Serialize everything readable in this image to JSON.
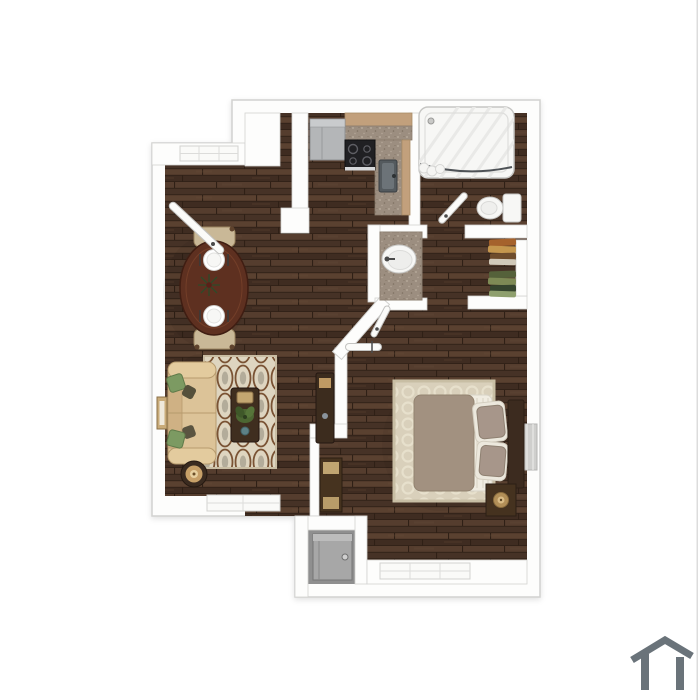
{
  "image": {
    "type": "3d-top-down-floor-plan",
    "unit": "one-bedroom one-bath apartment",
    "background": "#ffffff"
  },
  "palette": {
    "background": "#ffffff",
    "wall": "#fdfdfc",
    "wallEdge": "#d2d2d0",
    "floorBase": "#4b362a",
    "floorA": "#553d2e",
    "floorB": "#463226",
    "floorC": "#5a4130",
    "floorD": "#3f2c21",
    "floorSeam": "#2f2016",
    "floorStreak": "#6a4f3a",
    "utilityFloor": "#8f8f8f",
    "counterWood": "#c2a07c",
    "granite": "#9c8e80",
    "graniteLight": "#bcafa0",
    "graniteDark": "#7d7060",
    "fridge": "#b4b6b8",
    "stove": "#202023",
    "fixtureWhite": "#f7f7f5",
    "fixtureEdge": "#c6c6c4",
    "windowGlass": "#cfcfcd",
    "sofa": "#dcc398",
    "sofaEdge": "#b79b6e",
    "pillowGreen": "#7c9a62",
    "pillowOlive": "#55503b",
    "rugLiving": "#ded5c0",
    "rugLivingPattern": "#7a5334",
    "rugLivingAccent": "#b3ac9a",
    "rugBedroom": "#d9d0bb",
    "rugBedroomPattern": "#e7e0cc",
    "rugBedroomBorder": "#c8bea4",
    "tableWood": "#5e3020",
    "tableWoodEdge": "#3f1d12",
    "chairFabric": "#c9b897",
    "darkWood": "#3f2e1f",
    "duvet": "#a29180",
    "pillowTaupe": "#a7968a",
    "bedSheet": "#f0ece1",
    "headboard": "#3c2b1f",
    "nightstand": "#45321f",
    "lampGold": "#b28f58",
    "lampTan": "#c7a068",
    "handle": "#4a4a4a",
    "clothes1": "#a5622c",
    "clothes2": "#c5974e",
    "clothes3": "#6e4c2c",
    "clothes4": "#d1c9b9",
    "clothes5": "#55613a",
    "clothes6": "#7e8a55",
    "clothes7": "#36452e",
    "clothes8": "#8fa06e",
    "plantGreen": "#4c6632",
    "logo": "#6a737a",
    "edgeLine": "#dcdcdc"
  },
  "logo": {
    "icon": "house-outline-icon",
    "color": "#6a737a"
  },
  "rooms": [
    {
      "name": "living-dining",
      "furniture": [
        "sofa",
        "patterned-area-rug",
        "coffee-table",
        "plant",
        "side-table-lamp",
        "oval-dining-table",
        "two-dining-chairs",
        "two-place-settings",
        "wall-art",
        "media-console",
        "entry-door"
      ]
    },
    {
      "name": "kitchen",
      "furniture": [
        "refrigerator",
        "stove",
        "l-shaped-granite-counter",
        "kitchen-sink"
      ]
    },
    {
      "name": "bathroom",
      "furniture": [
        "bathtub",
        "shower-curtain",
        "toilet",
        "door"
      ]
    },
    {
      "name": "vanity-hall",
      "furniture": [
        "granite-vanity",
        "oval-sink"
      ]
    },
    {
      "name": "closet",
      "furniture": [
        "hanging-clothes",
        "shelf"
      ]
    },
    {
      "name": "bedroom",
      "furniture": [
        "bed",
        "pillows",
        "headboard",
        "nightstand-with-lamp",
        "trellis-rug",
        "tall-cabinet",
        "windows"
      ]
    },
    {
      "name": "utility-closet",
      "furniture": [
        "water-heater"
      ]
    }
  ]
}
